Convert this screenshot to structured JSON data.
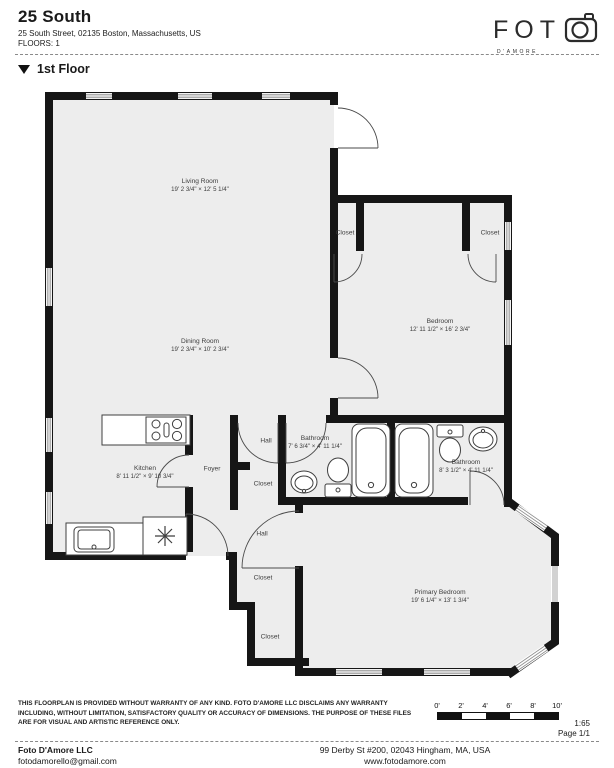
{
  "colors": {
    "wall": "#161616",
    "floor": "#ededed",
    "text": "#1a1a1a",
    "label_gray": "#3c3c3c"
  },
  "header": {
    "title": "25 South",
    "address": "25 South Street, 02135 Boston, Massachusetts, US",
    "floors": "FLOORS: 1"
  },
  "logo": {
    "name": "FOT",
    "tagline": "D'AMORE",
    "camera_icon": "camera-icon"
  },
  "floor_section": {
    "label": "1st Floor",
    "collapse_icon": "triangle-down-icon"
  },
  "plan": {
    "rooms": [
      {
        "name": "Living Room",
        "dims": "19' 2 3/4\" × 12' 5 1/4\""
      },
      {
        "name": "Dining Room",
        "dims": "19' 2 3/4\" × 10' 2 3/4\""
      },
      {
        "name": "Bedroom",
        "dims": "12' 11 1/2\" × 16' 2 3/4\""
      },
      {
        "name": "Kitchen",
        "dims": "8' 11 1/2\" × 9' 10 3/4\""
      },
      {
        "name": "Primary Bedroom",
        "dims": "19' 6 1/4\" × 13' 1 3/4\""
      },
      {
        "name": "Bathroom",
        "dims": "7' 6 3/4\" × 4' 11 1/4\""
      },
      {
        "name": "Bathroom",
        "dims": "8' 3 1/2\" × 4' 11 1/4\""
      },
      {
        "name": "Closet"
      },
      {
        "name": "Closet"
      },
      {
        "name": "Hall"
      },
      {
        "name": "Closet"
      },
      {
        "name": "Hall"
      },
      {
        "name": "Closet"
      },
      {
        "name": "Closet"
      },
      {
        "name": "Foyer"
      }
    ],
    "fixtures": [
      "stove-icon",
      "kitchen-sink-icon",
      "fridge-snowflake-icon",
      "bathtub-icon",
      "bathtub-icon",
      "toilet-icon",
      "toilet-icon",
      "bath-sink-icon",
      "bath-sink-icon"
    ]
  },
  "disclaimer": "THIS FLOORPLAN IS PROVIDED WITHOUT WARRANTY OF ANY KIND. FOTO D'AMORE LLC DISCLAIMS ANY WARRANTY INCLUDING, WITHOUT LIMITATION, SATISFACTORY QUALITY OR ACCURACY OF DIMENSIONS. THE PURPOSE OF THESE FILES ARE FOR VISUAL AND ARTISTIC REFERENCE ONLY.",
  "scale_bar": {
    "ticks": [
      "0'",
      "2'",
      "4'",
      "6'",
      "8'",
      "10'"
    ],
    "ratio": "1:65",
    "page": "Page 1/1"
  },
  "footer": {
    "company": "Foto D'Amore LLC",
    "email": "fotodamorello@gmail.com",
    "address": "99 Derby St #200, 02043 Hingham, MA, USA",
    "website": "www.fotodamore.com"
  }
}
